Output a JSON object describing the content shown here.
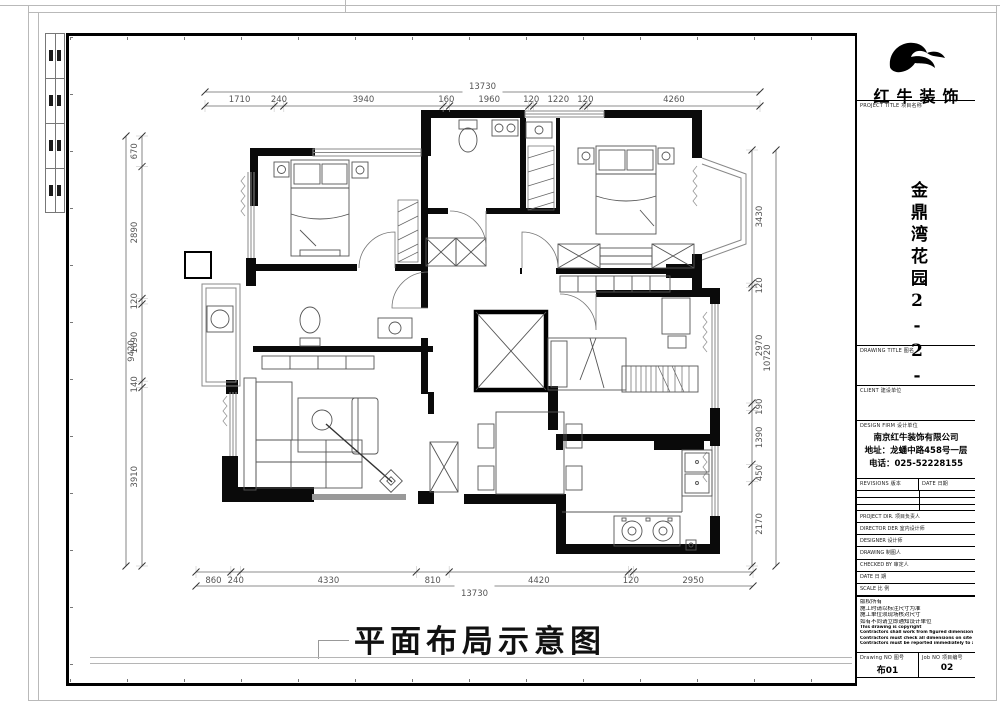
{
  "sheet": {
    "main_title": "平面布局示意图",
    "brand_name": "红牛装饰",
    "title_block": {
      "project_title_label": "PROJECT TITLE  项目名称",
      "project_name": "金鼎湾花园2-2-701",
      "drawing_title_label": "DRAWING TITLE  图名",
      "client_label": "CLIENT  建设单位",
      "design_firm_label": "DESIGN FIRM  设计单位",
      "firm_name": "南京红牛装饰有限公司",
      "firm_address": "地址：龙蟠中路458号一层",
      "firm_phone": "电话：025-52228155",
      "revisions_label": "REVISIONS  版本",
      "revisions_date_label": "DATE  日期",
      "staff_rows": [
        "PROJECT DIR.  项目负责人",
        "DIRECTOR DER  室内设计师",
        "DESIGNER  设计师",
        "DRAWING  制图人",
        "CHECKED BY  审定人",
        "DATE  日  期",
        "SCALE  比  例"
      ],
      "notes": [
        "版权所有",
        "施工时请以标注尺寸为准",
        "施工单位须现场核对尺寸",
        "如有不同请立即通知设计单位",
        "This drawing is copyright",
        "Contractors shall work from figured dimensions only",
        "Contractors must check all dimensions on site",
        "Contractors must be reported immediately to architects"
      ],
      "drawing_no_label": "Drawing NO  图号",
      "job_no_label": "Job NO  项目编号",
      "drawing_no_value": "布01",
      "job_no_value": "02"
    },
    "dimensions": {
      "top": {
        "total": "13730",
        "segments": [
          "1710",
          "240",
          "3940",
          "160",
          "1960",
          "120",
          "1220",
          "120",
          "4260"
        ]
      },
      "bottom": {
        "total": "13730",
        "segments": [
          "860",
          "240",
          "4330",
          "810",
          "4420",
          "120",
          "2950"
        ]
      },
      "left": {
        "total": "9420",
        "segments": [
          "670",
          "2890",
          "120",
          "1690",
          "140",
          "3910"
        ]
      },
      "right": {
        "total": "10720",
        "segments": [
          "3430",
          "120",
          "2970",
          "190",
          "1390",
          "450",
          "2170"
        ]
      }
    }
  }
}
